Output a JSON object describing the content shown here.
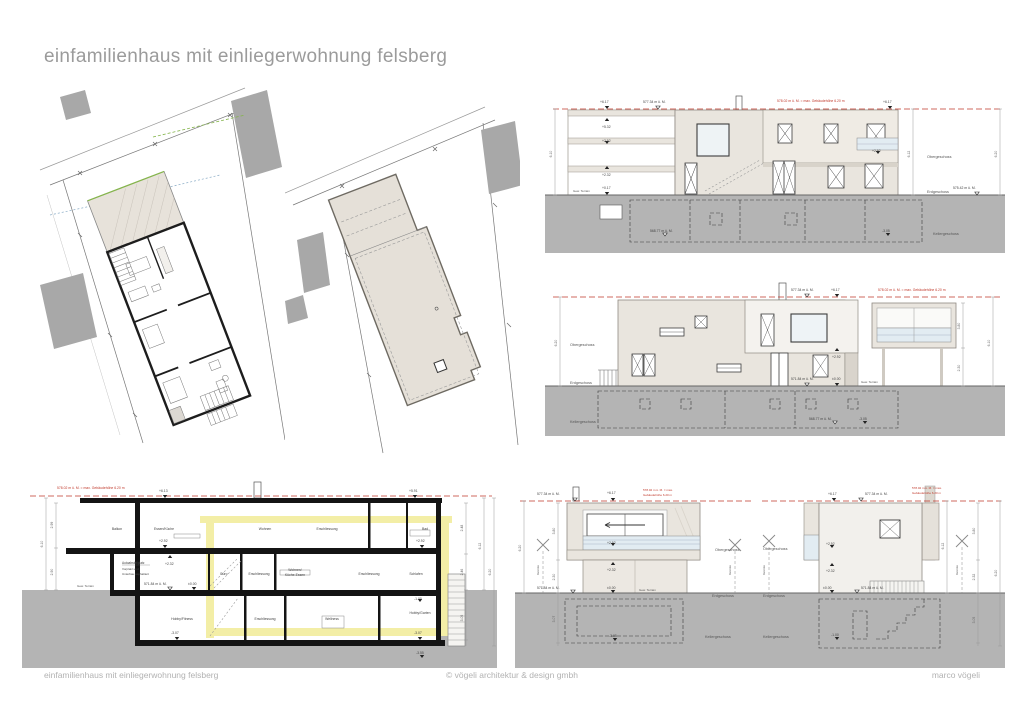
{
  "page": {
    "title": "einfamilienhaus mit einliegerwohnung felsberg",
    "footer": {
      "left": "einfamilienhaus mit einliegerwohnung felsberg",
      "center": "© vögeli architektur & design gmbh",
      "right": "marco vögeli"
    }
  },
  "colors": {
    "title_gray": "#9b9b9b",
    "facade_beige": "#e9e5de",
    "roof_beige": "#e5e0d8",
    "ground_gray": "#b4b4b4",
    "neighbor_gray": "#a8a8a8",
    "highlight_yellow": "#f3eea6",
    "red_line": "#c0392b",
    "glass_blue": "#e2ecf2",
    "wall_black": "#111111"
  },
  "labels": {
    "og": "Obergeschoss",
    "eg": "Erdgeschoss",
    "kg": "Kellergeschoss",
    "gew_terrain": "Gew. Terrain",
    "grenze": "Grenze"
  },
  "levels": {
    "p617": "+6.17",
    "p613": "+6.13",
    "p591": "+5.91",
    "p532": "+5.32",
    "p292": "+2.92",
    "p232": "+2.32",
    "p017": "+0.17",
    "zero": "±0.00",
    "m100": "-1.00",
    "m305": "-3.05",
    "m307": "-3.07",
    "m355": "-3.55"
  },
  "msl": {
    "roof": "577.34 m ü. M.",
    "street": "575.42 m ü. M.",
    "eg": "571.84 m ü. M.",
    "kg": "568.77 m ü. M."
  },
  "red_note": {
    "full": "578.02 m ü. M. = max. Gebäudehöhe 6.20 m",
    "l1": "578.02 m ü. M. = max.",
    "l2": "Gebäudehöhe 6.20 m"
  },
  "dims": {
    "d610": "6.10",
    "d612": "6.12",
    "d620": "6.20",
    "d299": "2.99",
    "d290": "2.90",
    "d248": "2.48",
    "d246": "2.46",
    "d230": "2.30",
    "d232": "2.32",
    "d305": "3.05",
    "d307": "3.07",
    "d380": "3.80"
  },
  "section": {
    "rooms_top": [
      "Balkon",
      "Essen/Küche",
      "Wohnen",
      "Erschliessung",
      "Bad"
    ],
    "rooms_mid": [
      "Büro",
      "Erschliessung",
      "Wohnen/",
      "Küche-Essen",
      "Erschliessung",
      "Schlafen"
    ],
    "rooms_kg": [
      "Hobby/Fitness",
      "Erschliessung",
      "Wellness",
      "Hobby/Garten"
    ],
    "carport": [
      "Autoabstellplatz",
      "Vorplatz und",
      "Unterbau asphaltiert"
    ]
  }
}
